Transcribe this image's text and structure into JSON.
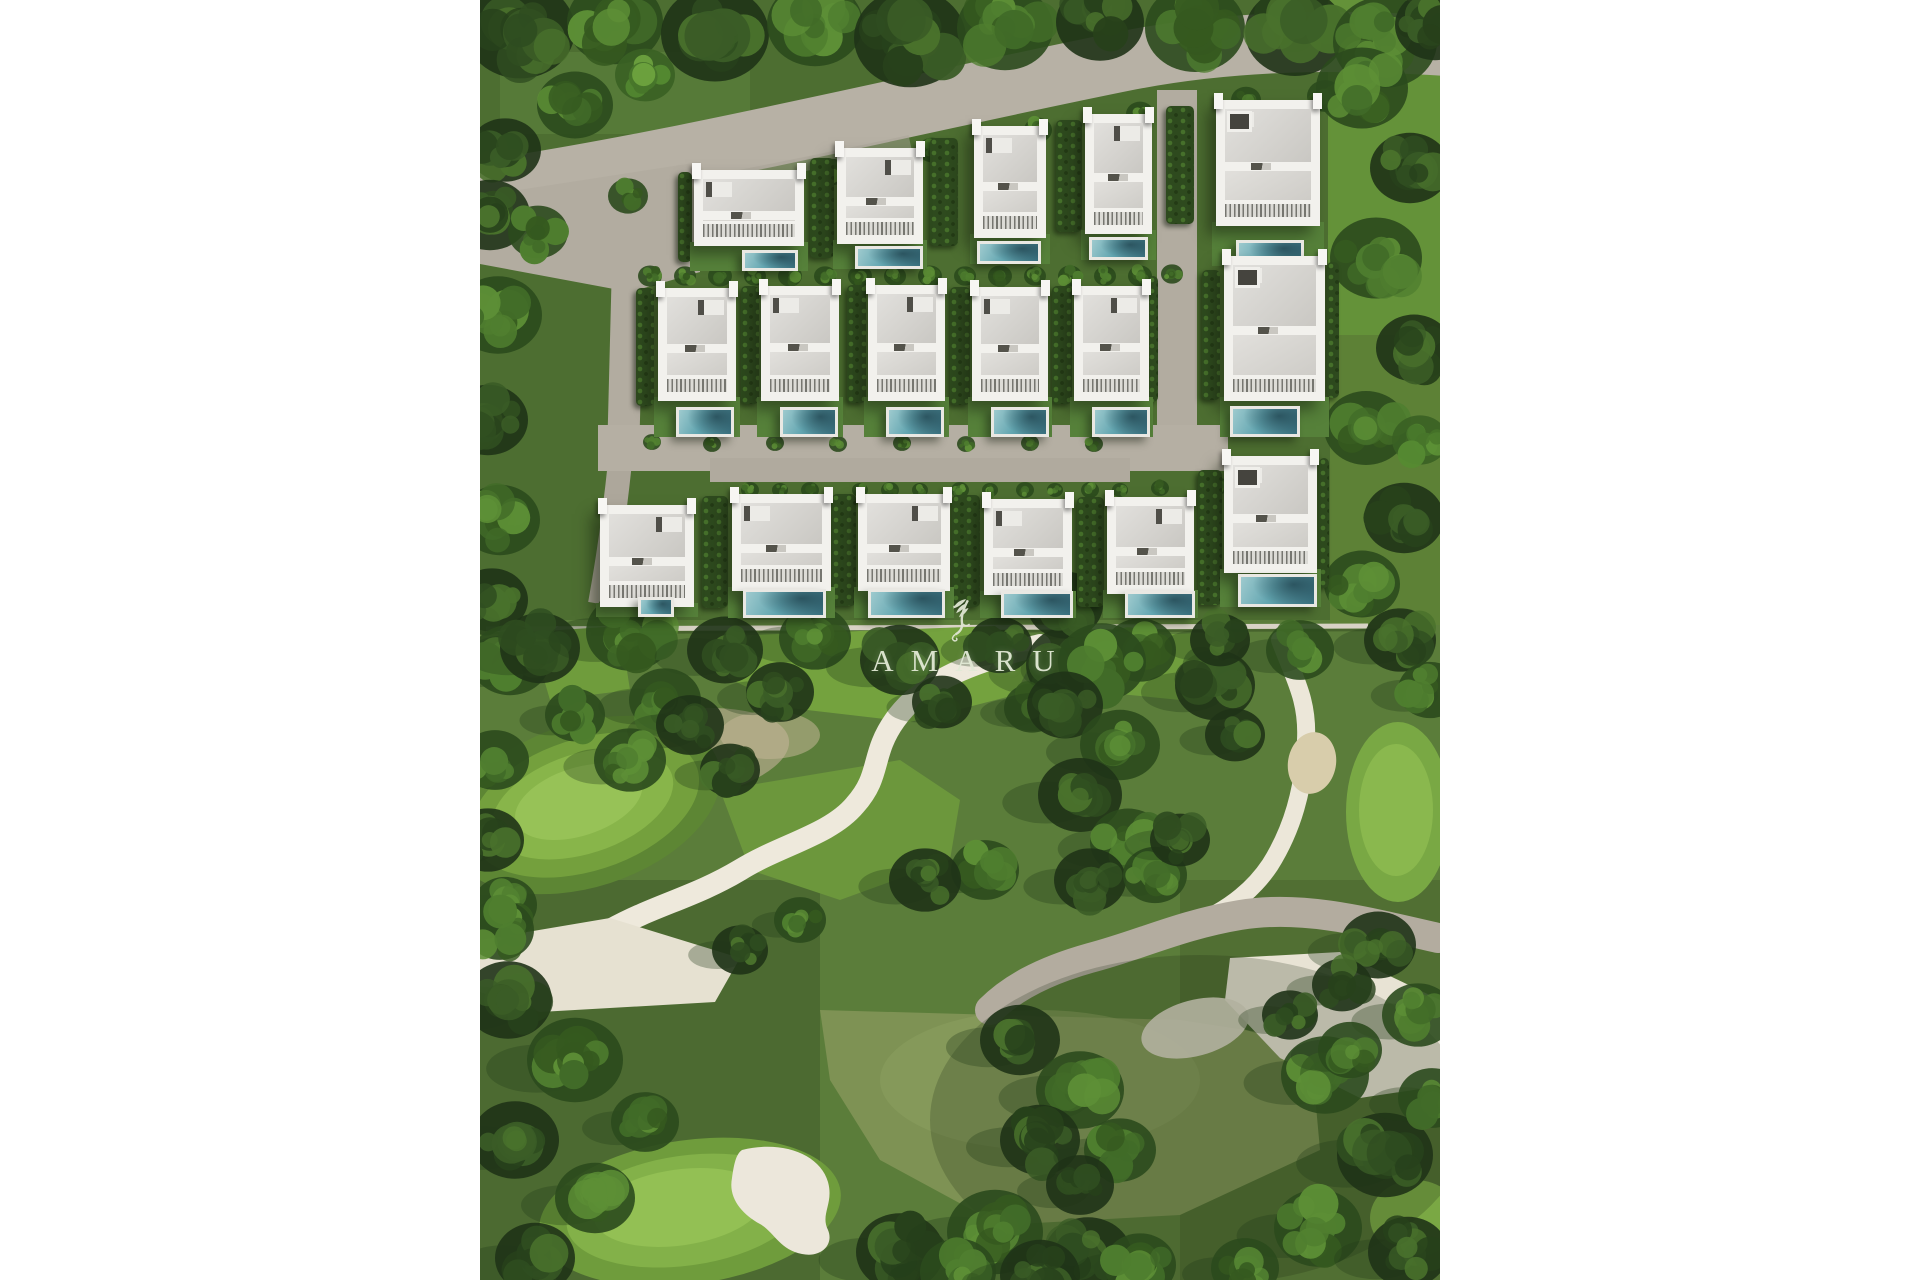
{
  "branding": {
    "name": "AMARU",
    "emblem": "winged-serpent-emblem",
    "logo_color": "#e2e9d5"
  },
  "scene": {
    "type": "aerial-development-render",
    "villas": {
      "row_top": 5,
      "row_middle": 6,
      "row_bottom": 6,
      "total": 17
    },
    "features": [
      "access-road",
      "private-pools",
      "hedged-gardens",
      "golf-course",
      "sand-paths",
      "tree-belts"
    ],
    "palette": {
      "canvas": "#ffffff",
      "tree_dark": "#24391b",
      "lawn": "#4d6e31",
      "fairway_bright": "#74a23e",
      "road_gray": "#b5afa3",
      "pool_teal": "#58a0ac",
      "roof_white": "#f2f1ed",
      "roof_gray": "#d6d4cf",
      "sand_white": "#ece7d9"
    }
  }
}
